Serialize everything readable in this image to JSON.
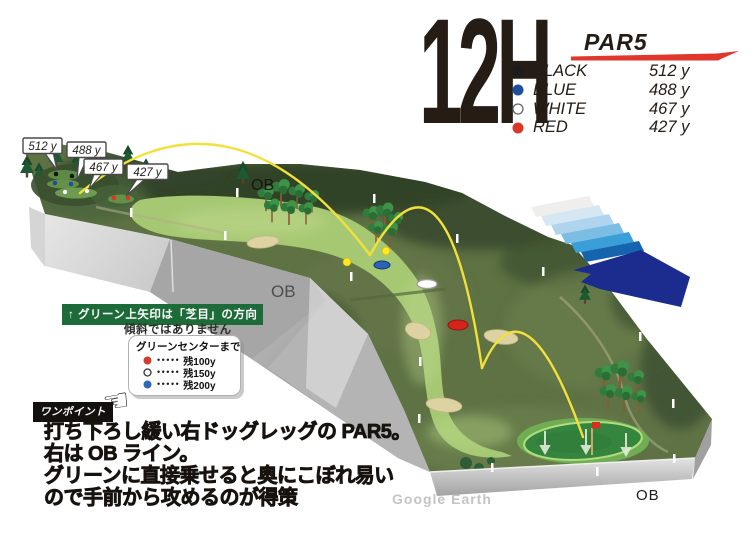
{
  "header": {
    "hole_number": "12H",
    "par_label": "PAR5",
    "accent_color": "#e0372c",
    "tee_rows": [
      {
        "name": "BLACK",
        "distance": "512 y",
        "dot_color": "#1c1c1c"
      },
      {
        "name": "BLUE",
        "distance": "488 y",
        "dot_color": "#1d4f9e"
      },
      {
        "name": "WHITE",
        "distance": "467 y",
        "dot_color": "#ffffff"
      },
      {
        "name": "RED",
        "distance": "427 y",
        "dot_color": "#d8372a"
      }
    ]
  },
  "map": {
    "callouts": [
      {
        "text": "512 y"
      },
      {
        "text": "488 y"
      },
      {
        "text": "467 y"
      },
      {
        "text": "427 y"
      }
    ],
    "ob_labels": {
      "top": "OB",
      "cliff": "OB",
      "bottom": "OB"
    },
    "watermark": "Google Earth",
    "flag_color": "#da2f1e",
    "trajectory_color": "#f4e03c"
  },
  "grain_note": {
    "bar_text": "↑ グリーン上矢印は「芝目」の方向",
    "sub_text": "傾斜ではありません",
    "bar_color": "#1e6b3a"
  },
  "distance_legend": {
    "title": "グリーンセンターまで",
    "leader": "•••••",
    "rows": [
      {
        "label": "残100y"
      },
      {
        "label": "残150y"
      },
      {
        "label": "残200y"
      }
    ],
    "dot_colors": {
      "red": "#d23c2e",
      "white": "#ffffff",
      "blue": "#2e68b8"
    }
  },
  "tip": {
    "badge": "ワンポイント",
    "hand": "☜",
    "lines": [
      "打ち下ろし緩い右ドッグレッグの PAR5。",
      "右は OB ライン。",
      "グリーンに直接乗せると奥にこぼれ易い",
      "ので手前から攻めるのが得策"
    ]
  }
}
